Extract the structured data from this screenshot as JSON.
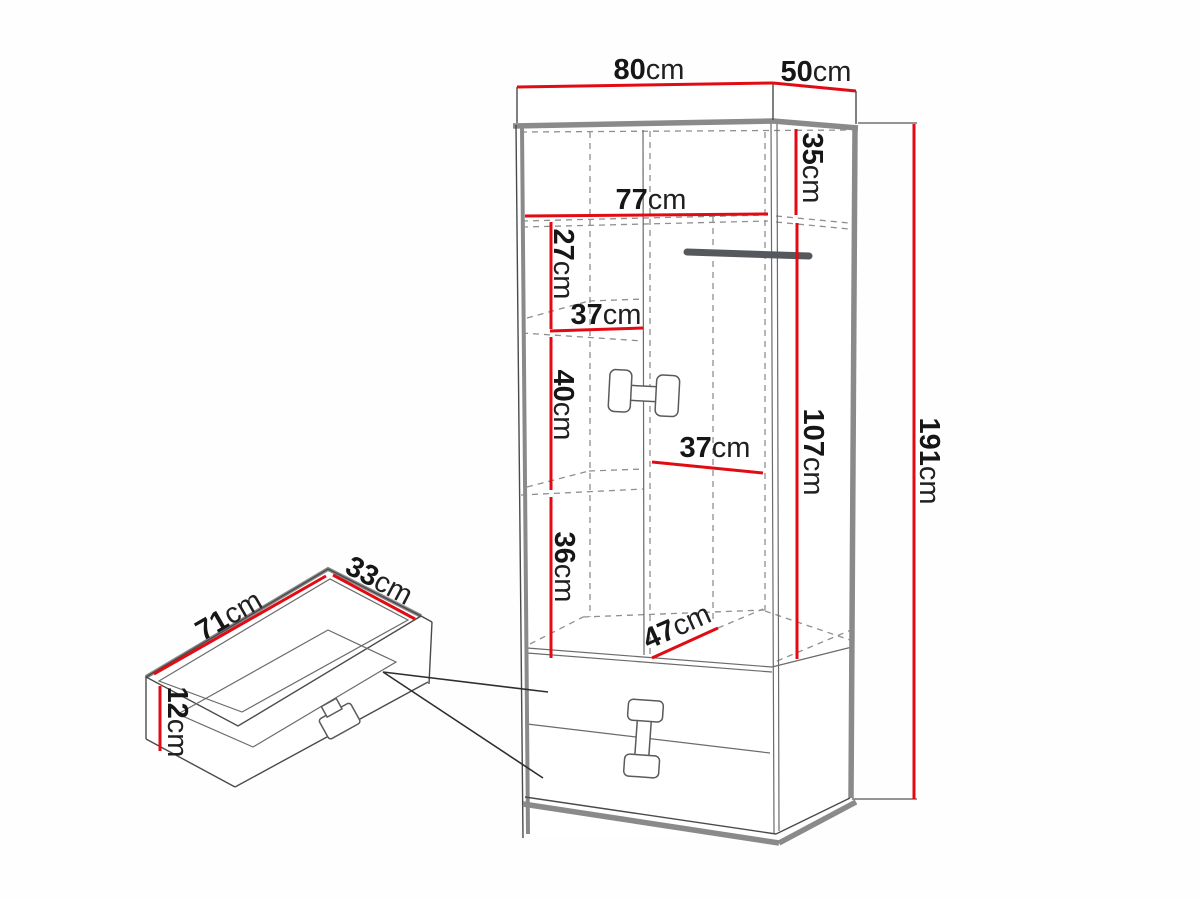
{
  "diagram_type": "furniture-dimension-drawing",
  "colors": {
    "dimension_red": "#e30b13",
    "outline_gray": "#8a8a8a",
    "line_dark": "#4a4a4a",
    "text": "#161616",
    "background": "#fefefe"
  },
  "wardrobe": {
    "description": "tall wardrobe with two doors, hanging rail, shelves and two bottom drawers",
    "dimensions": {
      "top_width": {
        "value": "80",
        "unit": "cm"
      },
      "top_depth": {
        "value": "50",
        "unit": "cm"
      },
      "top_section_height": {
        "value": "35",
        "unit": "cm"
      },
      "interior_width": {
        "value": "77",
        "unit": "cm"
      },
      "upper_gap_height": {
        "value": "27",
        "unit": "cm"
      },
      "upper_shelf_width": {
        "value": "37",
        "unit": "cm"
      },
      "middle_gap_height": {
        "value": "40",
        "unit": "cm"
      },
      "hanging_zone_width": {
        "value": "37",
        "unit": "cm"
      },
      "hanging_zone_height": {
        "value": "107",
        "unit": "cm"
      },
      "lower_gap_height": {
        "value": "36",
        "unit": "cm"
      },
      "interior_depth": {
        "value": "47",
        "unit": "cm"
      },
      "total_height": {
        "value": "191",
        "unit": "cm"
      }
    }
  },
  "drawer": {
    "description": "pull-out drawer box detail linked by pointer lines to the two drawer fronts",
    "dimensions": {
      "width": {
        "value": "71",
        "unit": "cm"
      },
      "depth": {
        "value": "33",
        "unit": "cm"
      },
      "height": {
        "value": "12",
        "unit": "cm"
      }
    }
  }
}
